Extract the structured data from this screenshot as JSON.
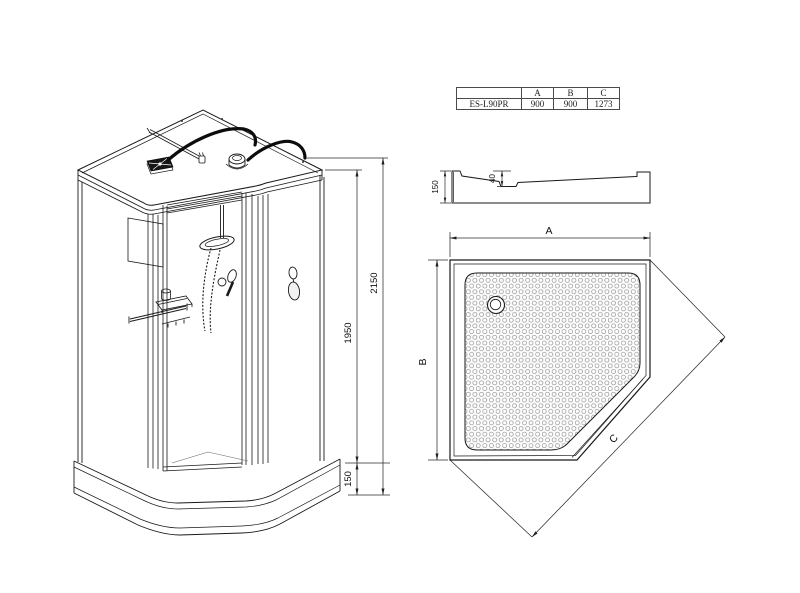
{
  "drawing": {
    "line_color": "#1a1a1a",
    "dim_color": "#2b2b2b",
    "texture_dot_color": "#8d8d8d"
  },
  "spec_table": {
    "corner_cell": "",
    "columns": [
      "A",
      "B",
      "C"
    ],
    "model": "ES-L90PR",
    "values": [
      "900",
      "900",
      "1273"
    ]
  },
  "iso_view": {
    "total_height": "2150",
    "body_height": "1950",
    "tray_height": "150"
  },
  "side_view": {
    "tray_height": "150",
    "basin_depth": "40"
  },
  "top_view": {
    "width_label": "A",
    "depth_label": "B",
    "front_label": "C"
  }
}
